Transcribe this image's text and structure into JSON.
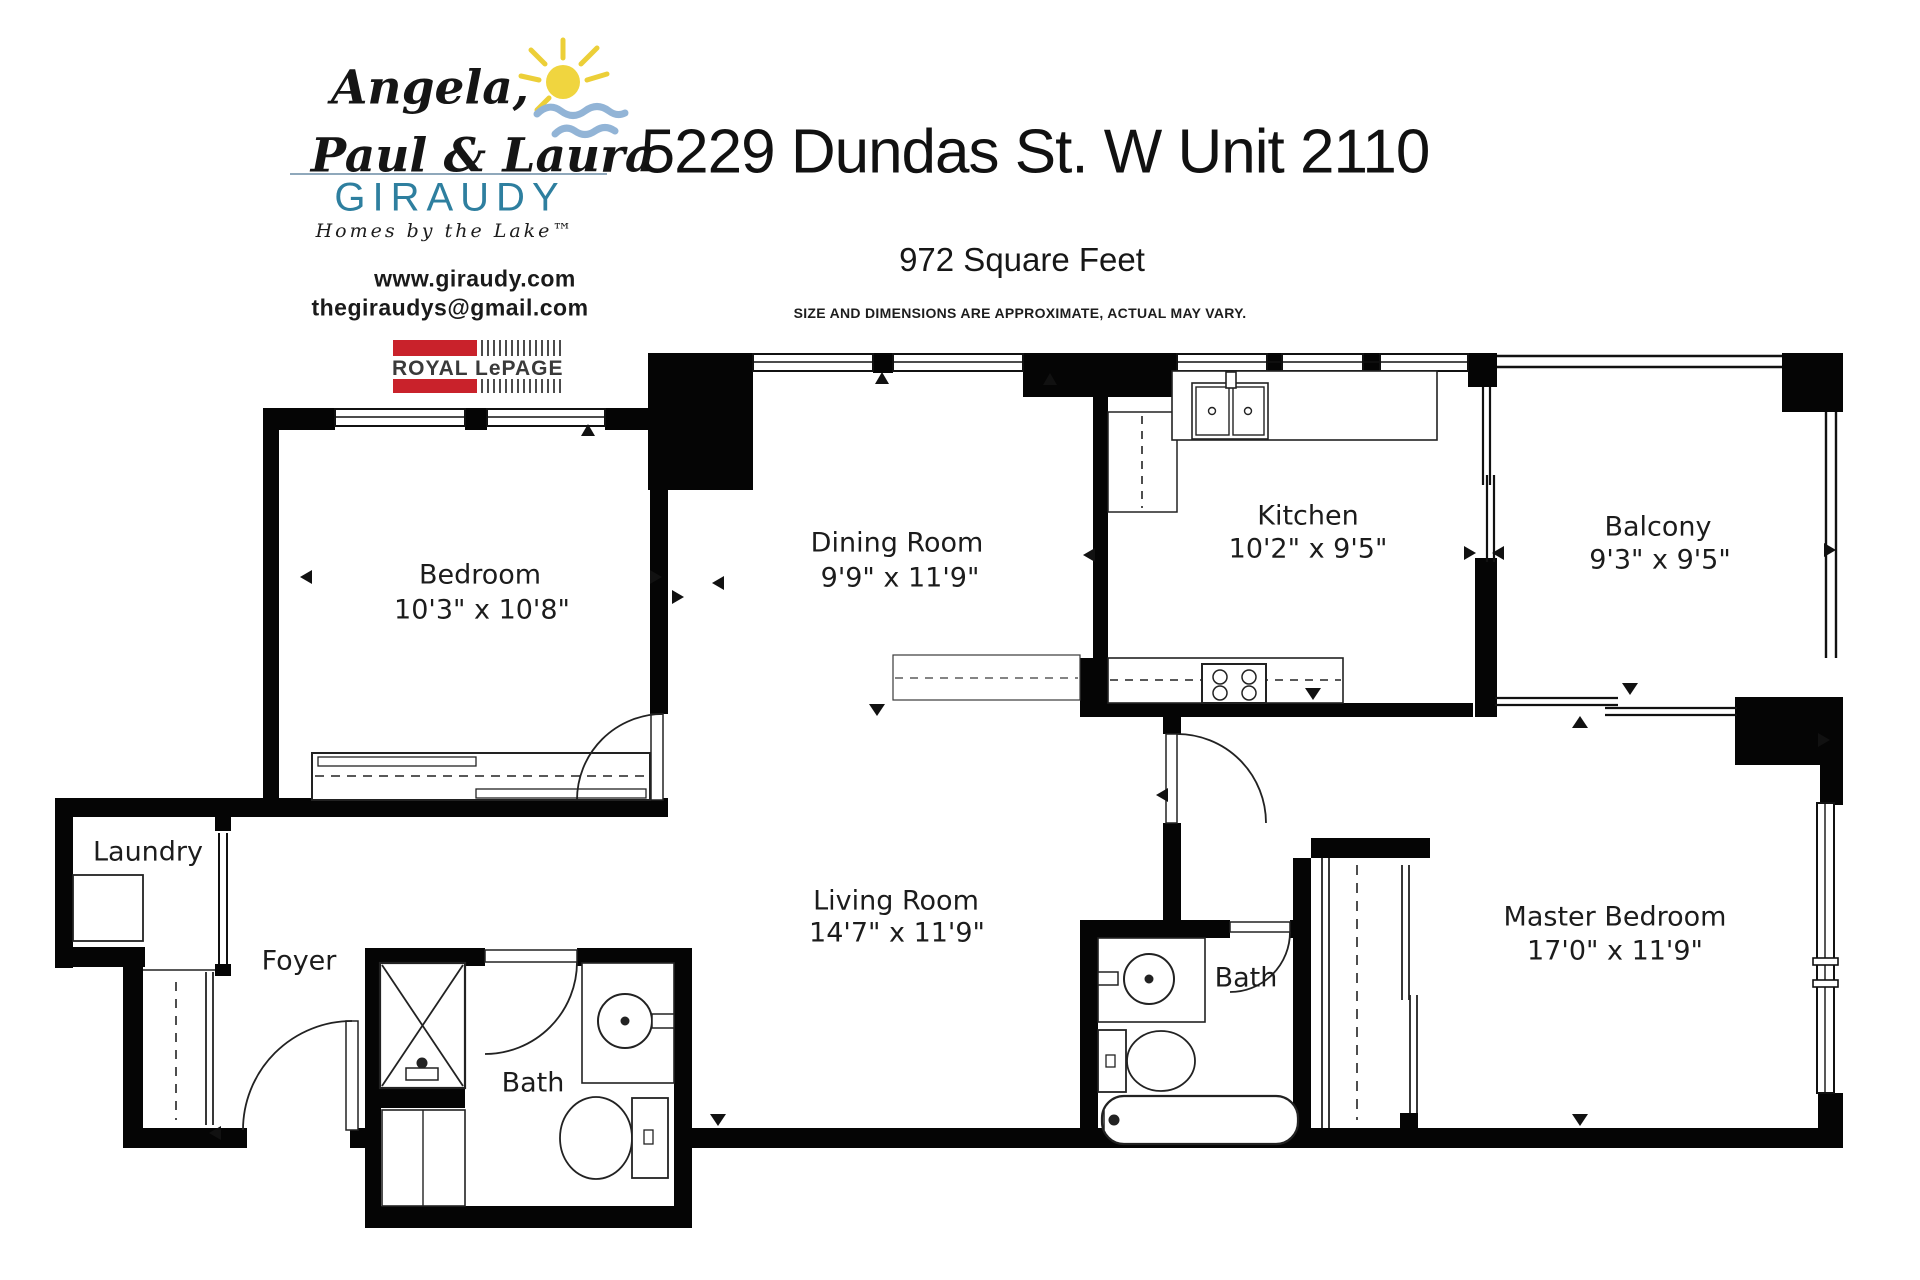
{
  "header": {
    "agents_line1": "Angela,",
    "agents_line2": "Paul & Laura",
    "brand": "GIRAUDY",
    "tagline": "Homes by the Lake™",
    "website": "www.giraudy.com",
    "email": "thegiraudys@gmail.com",
    "brokerage": "ROYAL LePAGE",
    "title": "5229 Dundas St. W Unit 2110",
    "subtitle": "972 Square Feet",
    "disclaimer": "SIZE AND DIMENSIONS ARE APPROXIMATE, ACTUAL MAY VARY."
  },
  "colors": {
    "wall_black": "#050505",
    "brand_teal": "#2e7f9f",
    "lepage_red": "#c9222b",
    "sun_yellow": "#f0d53f",
    "wave_blue": "#92b4d6"
  },
  "rooms": [
    {
      "id": "bedroom",
      "name": "Bedroom",
      "dims": "10'3\" x 10'8\""
    },
    {
      "id": "dining-room",
      "name": "Dining Room",
      "dims": "9'9\" x 11'9\""
    },
    {
      "id": "kitchen",
      "name": "Kitchen",
      "dims": "10'2\" x 9'5\""
    },
    {
      "id": "balcony",
      "name": "Balcony",
      "dims": "9'3\" x 9'5\""
    },
    {
      "id": "laundry",
      "name": "Laundry",
      "dims": ""
    },
    {
      "id": "foyer",
      "name": "Foyer",
      "dims": ""
    },
    {
      "id": "bath-main",
      "name": "Bath",
      "dims": ""
    },
    {
      "id": "living-room",
      "name": "Living Room",
      "dims": "14'7\" x 11'9\""
    },
    {
      "id": "bath-ensuite",
      "name": "Bath",
      "dims": ""
    },
    {
      "id": "master-bedroom",
      "name": "Master Bedroom",
      "dims": "17'0\" x 11'9\""
    }
  ]
}
